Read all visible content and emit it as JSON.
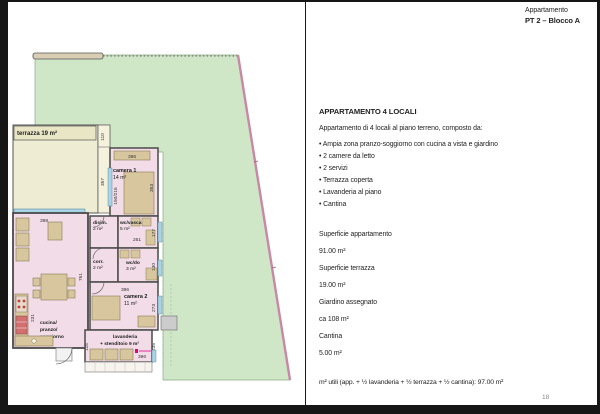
{
  "header": {
    "label": "Appartamento",
    "unit": "PT 2 – Blocco A"
  },
  "details": {
    "title": "APPARTAMENTO 4 LOCALI",
    "intro": "Appartamento di 4 locali al piano terreno, composto da:",
    "bullets": [
      "Ampia zona pranzo-soggiorno con cucina a vista e giardino",
      "2 camere da letto",
      "2 servizi",
      "Terrazza coperta",
      "Lavanderia al piano",
      "Cantina"
    ],
    "specs": [
      {
        "label": "Superficie appartamento",
        "value": "91.00 m²"
      },
      {
        "label": "Superficie terrazza",
        "value": "19.00 m²"
      },
      {
        "label": "Giardino assegnato",
        "value": "ca 108 m²"
      },
      {
        "label": "Cantina",
        "value": "5.00 m²"
      }
    ],
    "footnote": "m² utili (app. + ½ lavanderia + ½ terrazza + ½ cantina): 97.00 m²",
    "page_number": "18"
  },
  "plan": {
    "labels": {
      "terrazza": "terrazza 19 m²",
      "camera1": "camera 1",
      "camera1_area": "14 m²",
      "disim": "disim.",
      "disim_area": "2 m²",
      "wcvasca": "wc/vasca",
      "wcvasca_area": "5 m²",
      "corr": "corr.",
      "corr_area": "2 m²",
      "wcdo": "wc/do",
      "wcdo_area": "3 m²",
      "camera2": "camera 2",
      "camera2_area": "11 m²",
      "lav1": "lavanderia",
      "lav2": "+ stenditoio 9 m²",
      "cucina1": "cucina/",
      "cucina2": "pranzo/",
      "cucina3": "soggiorno",
      "cucina4": "31 m²"
    },
    "dims": {
      "t110": "110",
      "t357": "357",
      "c1_w": "396",
      "c1_win": "150/216",
      "c1_h": "353",
      "disim_w": "120",
      "wcvasca_w": "261",
      "wcvasca_h": "177",
      "wcdo_h": "130",
      "c2_w": "396",
      "c2_h": "273",
      "lav_l": "115",
      "lav_r": "235",
      "lav_w": "396",
      "liv_w": "398",
      "liv_h": "761",
      "liv_h2": "231"
    }
  },
  "colors": {
    "garden_green": "#cfe7c6",
    "room_pink": "#f1dce7",
    "terrace_cream": "#eeecd2",
    "furniture_tan": "#d8c79e",
    "window_blue": "#a8d4e6",
    "wall_gray": "#4a4a4a",
    "boundary_pink": "#c888a6",
    "vent_magenta": "#e6007e"
  }
}
